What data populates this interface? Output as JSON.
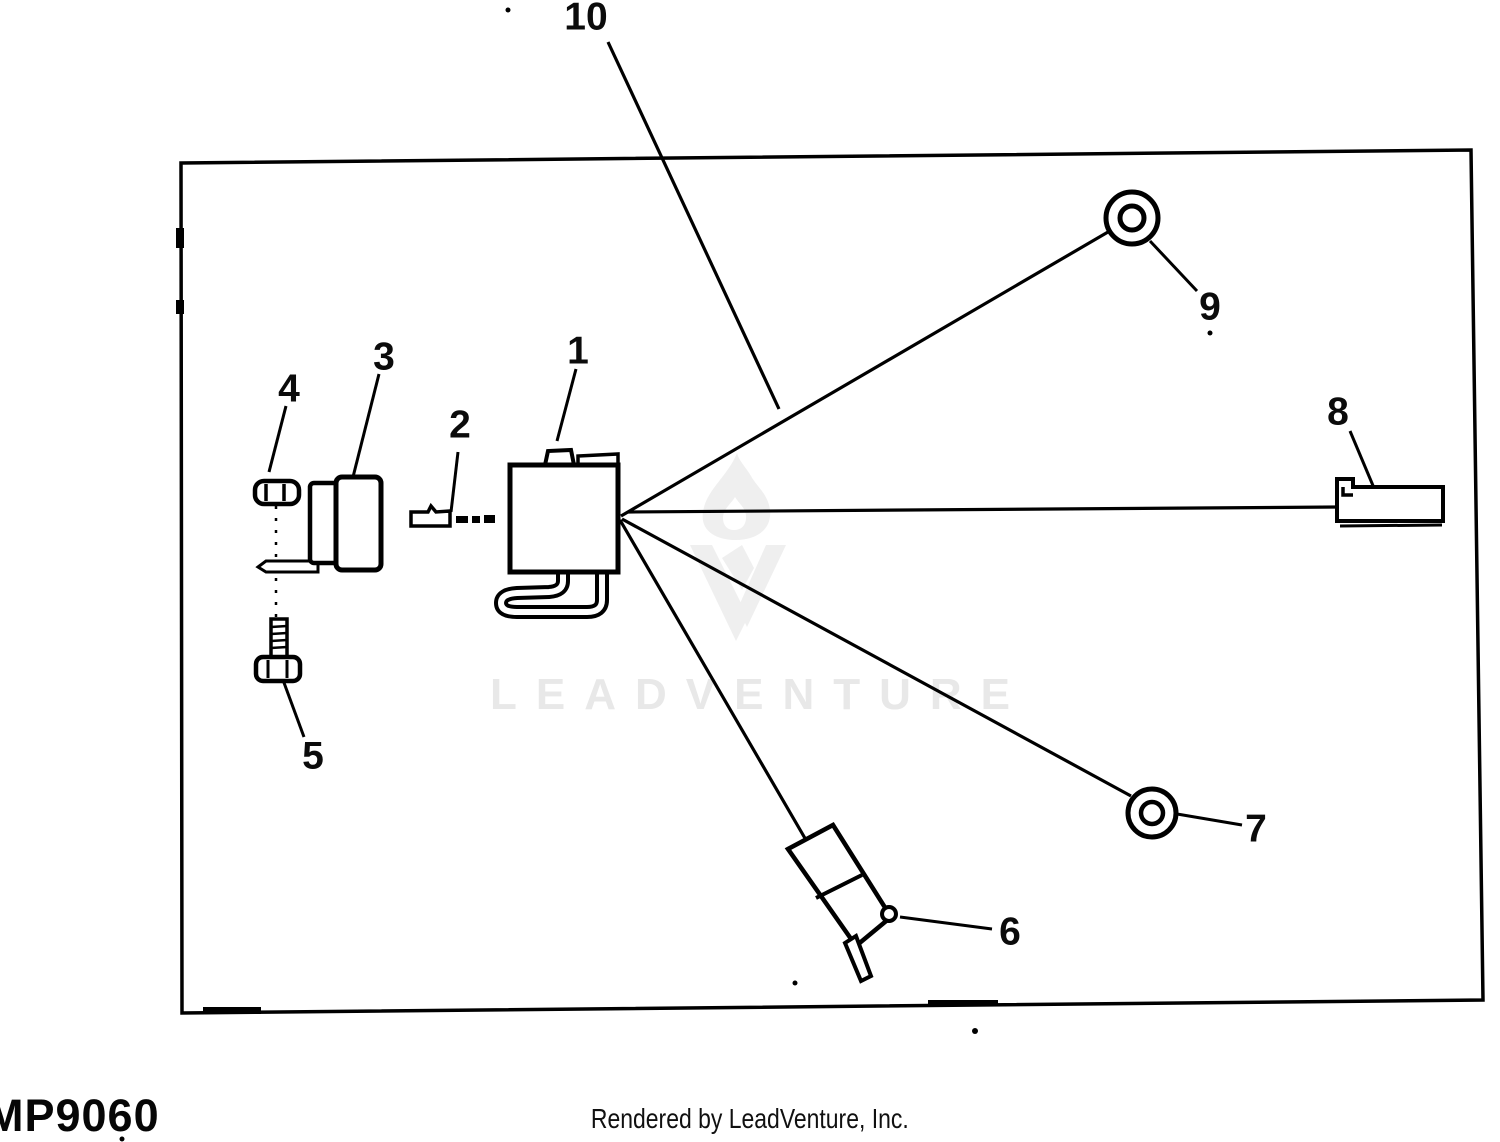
{
  "diagram": {
    "type": "exploded-parts-diagram",
    "callouts": [
      {
        "label": "1",
        "part": "control-module"
      },
      {
        "label": "2",
        "part": "mounting-plate"
      },
      {
        "label": "3",
        "part": "clamp-bracket"
      },
      {
        "label": "4",
        "part": "hex-nut"
      },
      {
        "label": "5",
        "part": "bolt"
      },
      {
        "label": "6",
        "part": "connector-plug"
      },
      {
        "label": "7",
        "part": "grommet-ring-small"
      },
      {
        "label": "8",
        "part": "connector-housing"
      },
      {
        "label": "9",
        "part": "grommet-ring-large"
      },
      {
        "label": "10",
        "part": "wiring-harness-assembly"
      }
    ],
    "colors": {
      "ink": "#000000",
      "background": "#ffffff",
      "watermark": "#e8e8e8",
      "watermark_logo": "#efefef"
    }
  },
  "watermark": {
    "text": "LEADVENTURE"
  },
  "footer": {
    "code": "MP9060",
    "rendered_by": "Rendered by LeadVenture, Inc."
  }
}
